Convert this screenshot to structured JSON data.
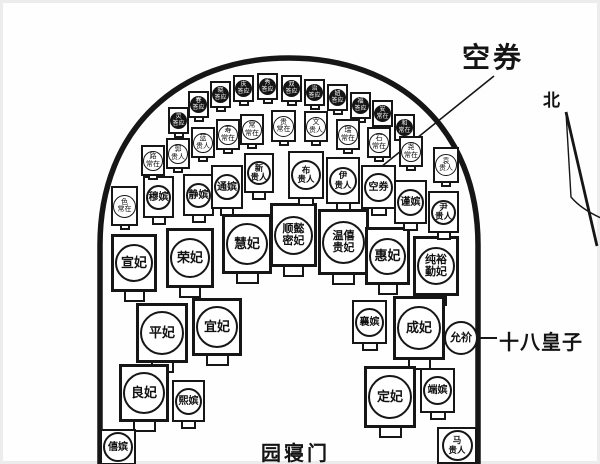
{
  "callouts": {
    "empty_vault": "空券",
    "north": "北",
    "prince": "十八皇子",
    "gate": "园寝门"
  },
  "colors": {
    "ink": "#161616",
    "paper": "#ffffff",
    "dark_marker": "#141414"
  },
  "tombs": [
    {
      "id": "xuan-fei",
      "lines": [
        "宣妃"
      ],
      "type": "large",
      "x": 111,
      "y": 234,
      "w": 46,
      "h": 58
    },
    {
      "id": "rong-fei",
      "lines": [
        "荣妃"
      ],
      "type": "large",
      "x": 166,
      "y": 228,
      "w": 48,
      "h": 60
    },
    {
      "id": "hui-fei-1",
      "lines": [
        "慧妃"
      ],
      "type": "large",
      "x": 222,
      "y": 214,
      "w": 50,
      "h": 60
    },
    {
      "id": "shunyi-mifei",
      "lines": [
        "顺懿",
        "密妃"
      ],
      "type": "large",
      "two": true,
      "x": 270,
      "y": 203,
      "w": 47,
      "h": 64
    },
    {
      "id": "wenxi-guifei",
      "lines": [
        "温僖",
        "贵妃"
      ],
      "type": "large",
      "two": true,
      "x": 318,
      "y": 209,
      "w": 51,
      "h": 66
    },
    {
      "id": "hui-fei-2",
      "lines": [
        "惠妃"
      ],
      "type": "large",
      "x": 365,
      "y": 227,
      "w": 45,
      "h": 58
    },
    {
      "id": "chunyu-qinfei",
      "lines": [
        "纯裕",
        "勤妃"
      ],
      "type": "large",
      "two": true,
      "x": 413,
      "y": 236,
      "w": 46,
      "h": 60
    },
    {
      "id": "ping-fei",
      "lines": [
        "平妃"
      ],
      "type": "large",
      "x": 136,
      "y": 303,
      "w": 52,
      "h": 60
    },
    {
      "id": "yi-fei",
      "lines": [
        "宜妃"
      ],
      "type": "large",
      "x": 192,
      "y": 298,
      "w": 50,
      "h": 58
    },
    {
      "id": "cheng-fei",
      "lines": [
        "成妃"
      ],
      "type": "large",
      "x": 393,
      "y": 296,
      "w": 52,
      "h": 64
    },
    {
      "id": "liang-fei",
      "lines": [
        "良妃"
      ],
      "type": "large",
      "x": 119,
      "y": 364,
      "w": 50,
      "h": 58
    },
    {
      "id": "ding-fei",
      "lines": [
        "定妃"
      ],
      "type": "large",
      "x": 364,
      "y": 366,
      "w": 52,
      "h": 62
    },
    {
      "id": "mu-pin",
      "lines": [
        "穆嫔"
      ],
      "type": "medium",
      "x": 143,
      "y": 176,
      "w": 31,
      "h": 42
    },
    {
      "id": "jing-pin",
      "lines": [
        "静嫔"
      ],
      "type": "medium",
      "x": 183,
      "y": 174,
      "w": 31,
      "h": 42
    },
    {
      "id": "tong-pin",
      "lines": [
        "通嫔"
      ],
      "type": "medium",
      "x": 211,
      "y": 165,
      "w": 32,
      "h": 44
    },
    {
      "id": "xin-guiren",
      "lines": [
        "新",
        "贵人"
      ],
      "type": "medium",
      "two": true,
      "x": 244,
      "y": 153,
      "w": 30,
      "h": 40
    },
    {
      "id": "bu-guiren",
      "lines": [
        "布",
        "贵人"
      ],
      "type": "medium",
      "two": true,
      "x": 288,
      "y": 151,
      "w": 36,
      "h": 48
    },
    {
      "id": "yi-guiren",
      "lines": [
        "伊",
        "贵人"
      ],
      "type": "medium",
      "two": true,
      "x": 326,
      "y": 157,
      "w": 34,
      "h": 47
    },
    {
      "id": "kong-quan",
      "lines": [
        "空券"
      ],
      "type": "medium",
      "x": 361,
      "y": 165,
      "w": 35,
      "h": 44
    },
    {
      "id": "jin-pin",
      "lines": [
        "谨嫔"
      ],
      "type": "medium",
      "x": 394,
      "y": 180,
      "w": 33,
      "h": 44
    },
    {
      "id": "yin-guiren",
      "lines": [
        "尹",
        "贵人"
      ],
      "type": "medium",
      "two": true,
      "x": 428,
      "y": 191,
      "w": 31,
      "h": 42
    },
    {
      "id": "xiang-pin",
      "lines": [
        "襄嫔"
      ],
      "type": "medium",
      "x": 352,
      "y": 300,
      "w": 35,
      "h": 44
    },
    {
      "id": "xi-pin-2",
      "lines": [
        "熙嫔"
      ],
      "type": "medium",
      "x": 172,
      "y": 380,
      "w": 33,
      "h": 42
    },
    {
      "id": "duan-pin",
      "lines": [
        "端嫔"
      ],
      "type": "medium",
      "x": 420,
      "y": 368,
      "w": 35,
      "h": 45
    },
    {
      "id": "xi-pin-1",
      "lines": [
        "僖嫔"
      ],
      "type": "medium",
      "x": 100,
      "y": 429,
      "w": 36,
      "h": 36,
      "ped": false
    },
    {
      "id": "ma-guiren",
      "lines": [
        "马",
        "贵人"
      ],
      "type": "medium",
      "two": true,
      "x": 437,
      "y": 427,
      "w": 40,
      "h": 37,
      "ped": false
    },
    {
      "id": "yun-xie",
      "lines": [
        "允祄"
      ],
      "type": "circle-only",
      "x": 444,
      "y": 321,
      "w": 34,
      "h": 34,
      "ped": false
    },
    {
      "id": "ling-daying",
      "lines": [
        "灵",
        "答应"
      ],
      "type": "sdark",
      "x": 168,
      "y": 107,
      "w": 21,
      "h": 27
    },
    {
      "id": "chun-daying",
      "lines": [
        "春",
        "答应"
      ],
      "type": "sdark",
      "x": 188,
      "y": 91,
      "w": 21,
      "h": 27
    },
    {
      "id": "xiao-daying",
      "lines": [
        "晓",
        "答应"
      ],
      "type": "sdark",
      "x": 210,
      "y": 81,
      "w": 21,
      "h": 27
    },
    {
      "id": "qing-daying",
      "lines": [
        "庆",
        "答应"
      ],
      "type": "sdark",
      "x": 233,
      "y": 75,
      "w": 21,
      "h": 27
    },
    {
      "id": "xiu-daying",
      "lines": [
        "秀",
        "答应"
      ],
      "type": "sdark",
      "x": 257,
      "y": 73,
      "w": 21,
      "h": 27
    },
    {
      "id": "shuang-daying",
      "lines": [
        "双",
        "答应"
      ],
      "type": "sdark",
      "x": 281,
      "y": 75,
      "w": 21,
      "h": 27
    },
    {
      "id": "zhi-daying",
      "lines": [
        "治",
        "答应"
      ],
      "type": "sdark",
      "x": 304,
      "y": 79,
      "w": 21,
      "h": 27
    },
    {
      "id": "niu-daying",
      "lines": [
        "妞",
        "答应"
      ],
      "type": "sdark",
      "x": 327,
      "y": 84,
      "w": 21,
      "h": 27
    },
    {
      "id": "fu-daying",
      "lines": [
        "福",
        "答应"
      ],
      "type": "sdark",
      "x": 350,
      "y": 92,
      "w": 21,
      "h": 27
    },
    {
      "id": "an-changzai",
      "lines": [
        "安",
        "常在"
      ],
      "type": "sdark",
      "x": 372,
      "y": 100,
      "w": 21,
      "h": 27
    },
    {
      "id": "he-changzai",
      "lines": [
        "和",
        "常在"
      ],
      "type": "sdark",
      "x": 394,
      "y": 114,
      "w": 21,
      "h": 27
    },
    {
      "id": "se-changzai",
      "lines": [
        "色",
        "常在"
      ],
      "type": "slight",
      "x": 111,
      "y": 186,
      "w": 27,
      "h": 40
    },
    {
      "id": "lu-changzai",
      "lines": [
        "路",
        "常在"
      ],
      "type": "slight",
      "x": 141,
      "y": 145,
      "w": 24,
      "h": 31
    },
    {
      "id": "guo-guiren",
      "lines": [
        "郭",
        "贵人"
      ],
      "type": "slight",
      "x": 166,
      "y": 138,
      "w": 24,
      "h": 31
    },
    {
      "id": "lan-guiren",
      "lines": [
        "蓝",
        "贵人"
      ],
      "type": "slight",
      "x": 191,
      "y": 127,
      "w": 24,
      "h": 31
    },
    {
      "id": "shou-changzai",
      "lines": [
        "寿",
        "常在"
      ],
      "type": "slight",
      "x": 216,
      "y": 119,
      "w": 24,
      "h": 31
    },
    {
      "id": "chang-changzai",
      "lines": [
        "常",
        "常在"
      ],
      "type": "slight",
      "x": 240,
      "y": 114,
      "w": 24,
      "h": 31
    },
    {
      "id": "gui-changzai",
      "lines": [
        "贵",
        "常在"
      ],
      "type": "slight",
      "x": 271,
      "y": 110,
      "w": 25,
      "h": 32
    },
    {
      "id": "wen-guiren",
      "lines": [
        "文",
        "贵人"
      ],
      "type": "slight",
      "x": 304,
      "y": 111,
      "w": 24,
      "h": 31
    },
    {
      "id": "rui-changzai",
      "lines": [
        "瑞",
        "常在"
      ],
      "type": "slight",
      "x": 336,
      "y": 119,
      "w": 24,
      "h": 31
    },
    {
      "id": "shi-changzai",
      "lines": [
        "石",
        "常在"
      ],
      "type": "slight",
      "x": 367,
      "y": 127,
      "w": 24,
      "h": 31
    },
    {
      "id": "yao-changzai",
      "lines": [
        "尧",
        "常在"
      ],
      "type": "slight",
      "x": 399,
      "y": 136,
      "w": 24,
      "h": 31
    },
    {
      "id": "yuan-guiren",
      "lines": [
        "袁",
        "贵人"
      ],
      "type": "slight",
      "x": 433,
      "y": 147,
      "w": 26,
      "h": 36
    }
  ]
}
